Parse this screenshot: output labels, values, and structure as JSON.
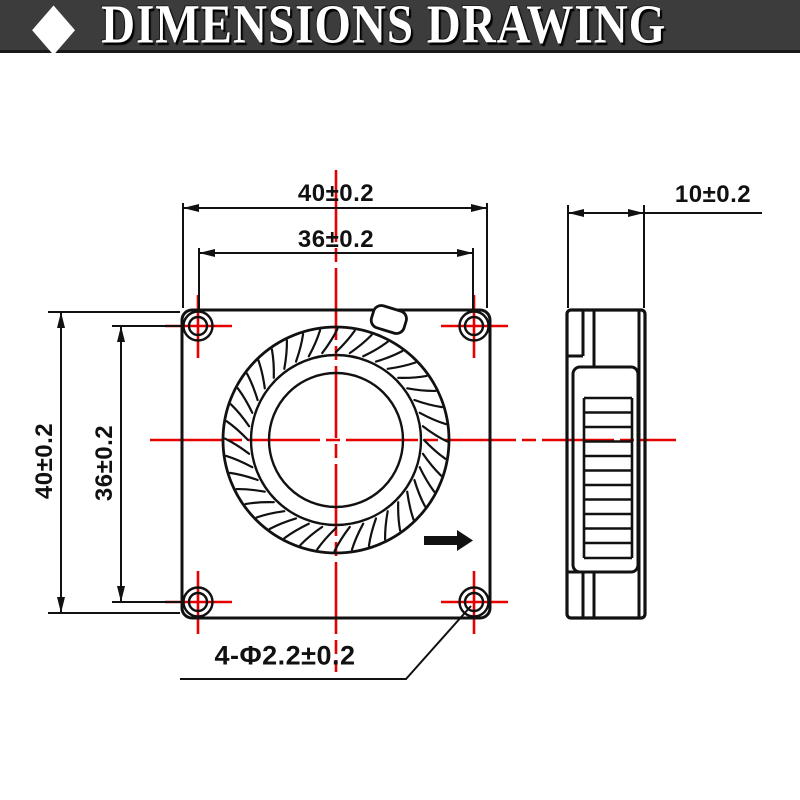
{
  "header": {
    "title": "DIMENSIONS DRAWING",
    "diamond_glyph": "◆"
  },
  "drawing": {
    "front_view": {
      "width_label": "40±0.2",
      "inner_width_label": "36±0.2",
      "height_label": "40±0.2",
      "inner_height_label": "36±0.2",
      "holes_note": "4-Φ2.2±0.2"
    },
    "side_view": {
      "depth_label": "10±0.2"
    },
    "colors": {
      "outline": "#111111",
      "centerline_red": "#e60000",
      "banner_background": "#3c3c3c",
      "banner_text": "#ffffff"
    }
  }
}
